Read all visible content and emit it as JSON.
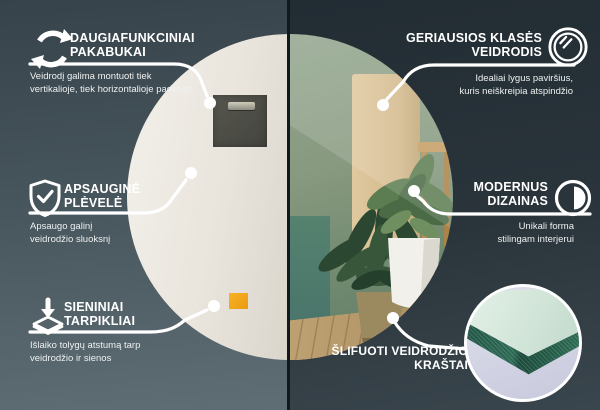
{
  "callouts": {
    "left": [
      {
        "icon": "rotate-arrows-icon",
        "title": "DAUGIAFUNKCINIAI\nPAKABUKAI",
        "description": "Veidrodį galima montuoti tiek\nvertikalioje, tiek horizontalioje padėtyje"
      },
      {
        "icon": "shield-check-icon",
        "title": "APSAUGINĖ\nPLĖVELĖ",
        "description": "Apsaugo galinį\nveidrodžio sluoksnį"
      },
      {
        "icon": "wall-spacer-icon",
        "title": "SIENINIAI\nTARPIKLIAI",
        "description": "Išlaiko tolygų atstumą tarp\nveidrodžio ir sienos"
      }
    ],
    "right": [
      {
        "icon": "mirror-circle-icon",
        "title": "GERIAUSIOS KLASĖS\nVEIDRODIS",
        "description": "Idealiai lygus paviršius,\nkuris neiškreipia atspindžio"
      },
      {
        "icon": "contrast-circle-icon",
        "title": "MODERNUS\nDIZAINAS",
        "description": "Unikali forma\nstilingam interjerui"
      },
      {
        "icon": "polished-edge-photo",
        "title": "ŠLIFUOTI VEIDRODŽIO\nKRAŠTAI",
        "description": ""
      }
    ]
  },
  "colors": {
    "background_left": "#46545C",
    "background_right": "#28323A",
    "divider": "#12191E",
    "callout_line": "#FFFFFF",
    "mirror_back": "#EDEAE3",
    "hanger_pad": "#4B4B45",
    "spacer_accent_orange": "#F2A51E",
    "reflection_wall_green": "#86997F",
    "reflection_floor_wood": "#B59A6C",
    "glass_edge_green": "#2C6A54"
  }
}
